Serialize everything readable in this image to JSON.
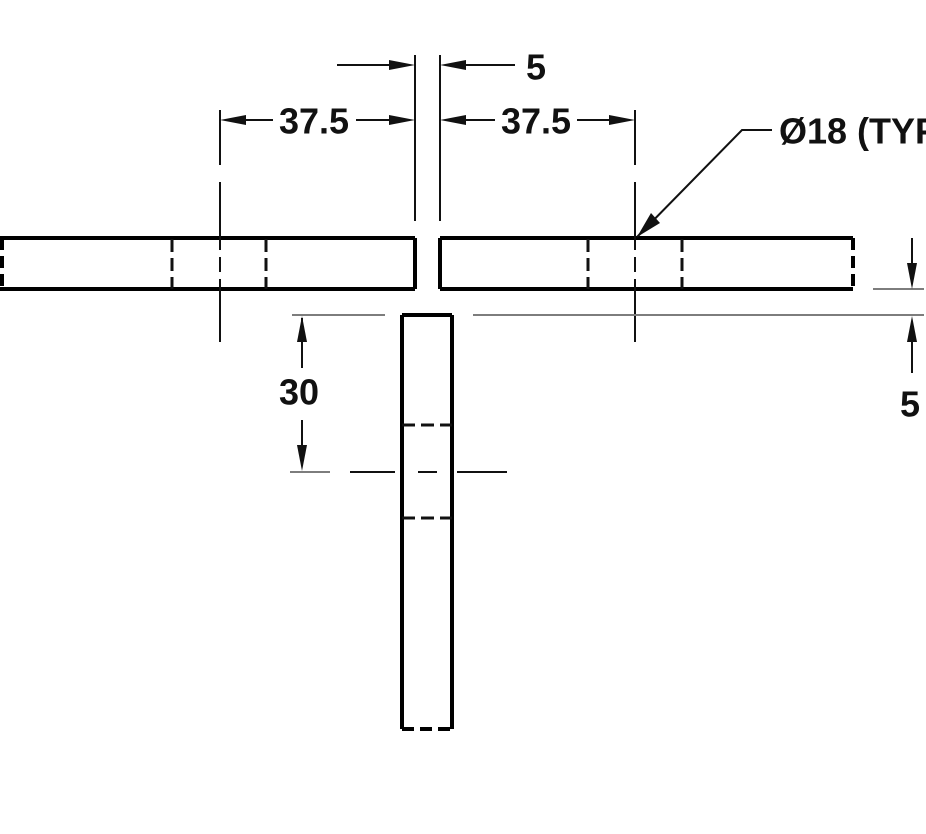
{
  "drawing": {
    "type": "technical-dimension-drawing",
    "dimensions": {
      "gap_top": "5",
      "left_offset": "37.5",
      "right_offset": "37.5",
      "depth": "30",
      "gap_right": "5"
    },
    "note": {
      "hole": "Ø18 (TYP"
    },
    "colors": {
      "object_line": "#000000",
      "line": "#111111",
      "thin_line": "#7d7d7d",
      "text": "#111111",
      "background": "#ffffff"
    }
  }
}
